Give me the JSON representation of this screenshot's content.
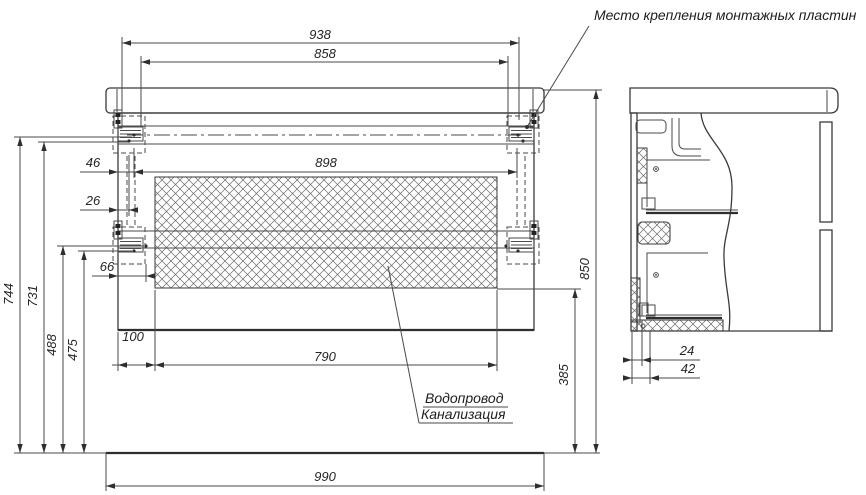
{
  "drawing": {
    "annotations": {
      "mounting_plates_leader": "Место крепления монтажных пластин",
      "utilities_line1": "Водопровод",
      "utilities_line2": "Канализация"
    },
    "dimensions_mm": {
      "d938": "938",
      "d858": "858",
      "d898": "898",
      "d46": "46",
      "d26": "26",
      "d66": "66",
      "d744": "744",
      "d731": "731",
      "d488": "488",
      "d475": "475",
      "d100": "100",
      "d790": "790",
      "d990": "990",
      "d385": "385",
      "d850": "850",
      "d24": "24",
      "d42": "42"
    },
    "colors": {
      "line": "#3a3a3a",
      "background": "#ffffff"
    }
  }
}
